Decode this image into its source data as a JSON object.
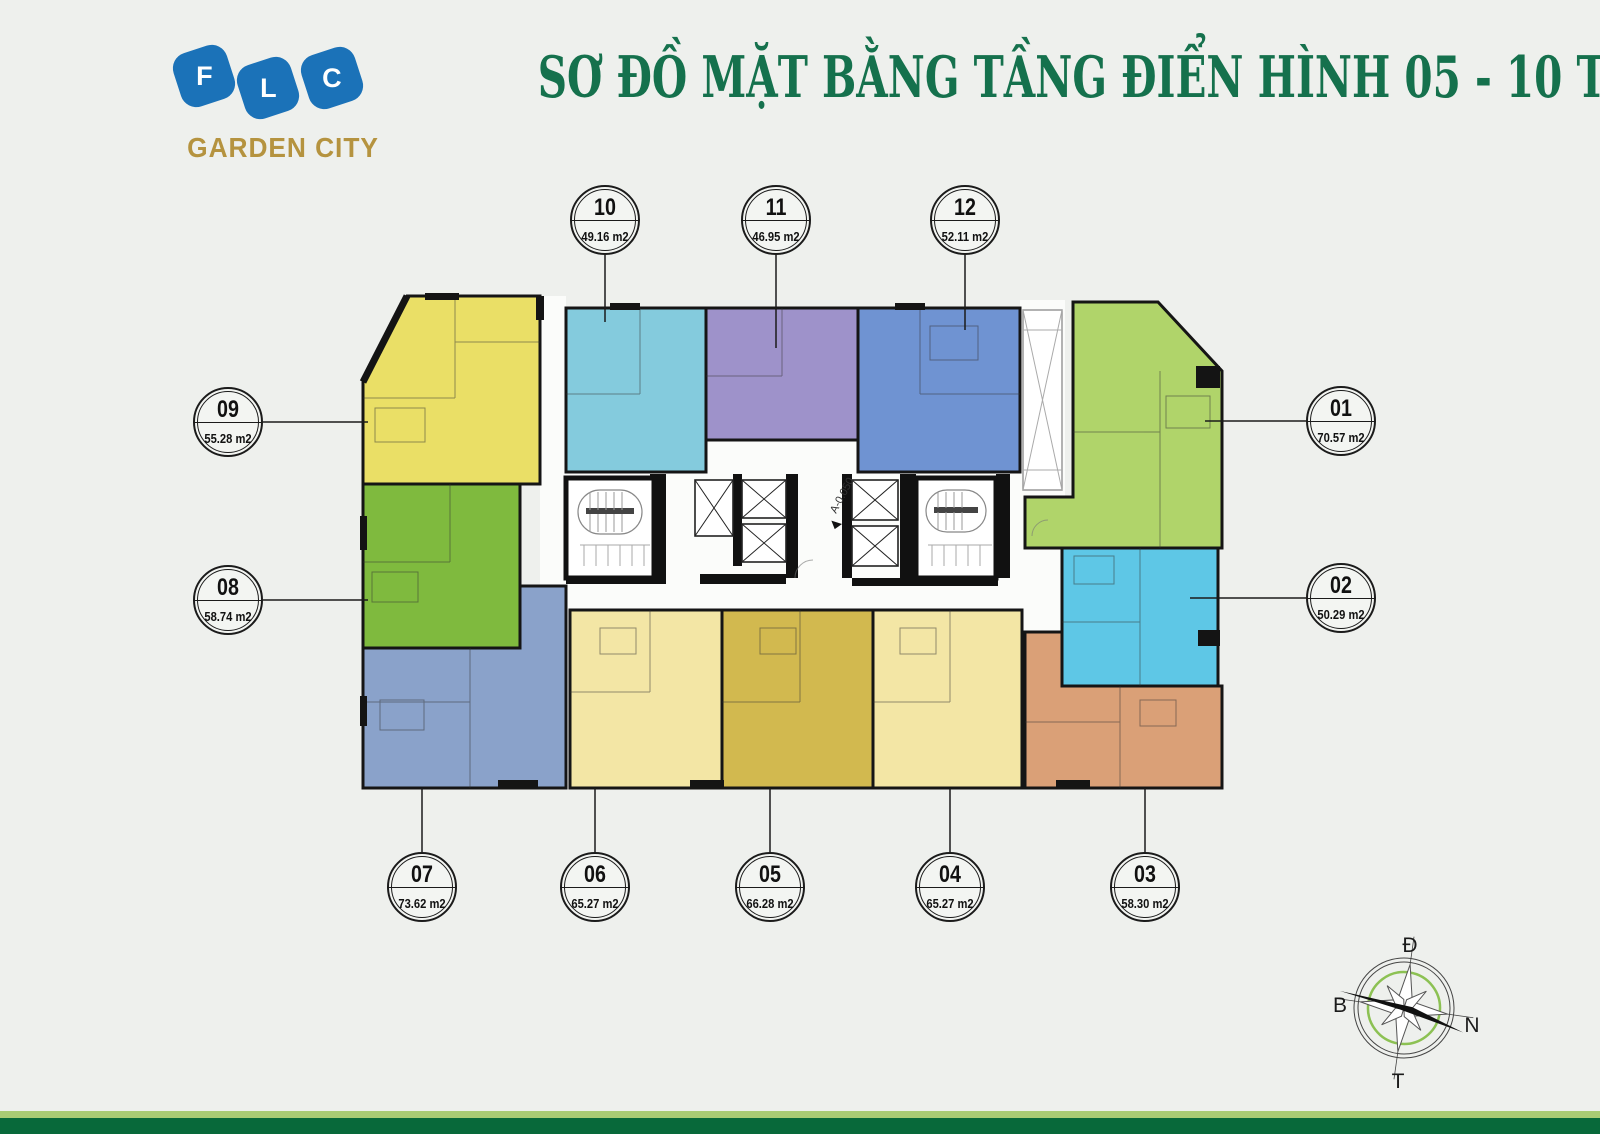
{
  "header": {
    "title": "SƠ ĐỒ MẶT BẰNG TẦNG ĐIỂN HÌNH 05 - 10 TÒA HH4",
    "title_color": "#15714d"
  },
  "logo": {
    "letters": [
      "F",
      "L",
      "C"
    ],
    "subtitle": "GARDEN CITY",
    "brand_blue": "#1b72b8",
    "brand_gold": "#b5933f"
  },
  "callouts": {
    "u01": {
      "number": "01",
      "area": "70.57 m2",
      "color": "#b0d46a"
    },
    "u02": {
      "number": "02",
      "area": "50.29 m2",
      "color": "#5ec7e6"
    },
    "u03": {
      "number": "03",
      "area": "58.30 m2",
      "color": "#daa077"
    },
    "u04": {
      "number": "04",
      "area": "65.27 m2",
      "color": "#f3e6a5"
    },
    "u05": {
      "number": "05",
      "area": "66.28 m2",
      "color": "#d2b94f"
    },
    "u06": {
      "number": "06",
      "area": "65.27 m2",
      "color": "#f3e6a5"
    },
    "u07": {
      "number": "07",
      "area": "73.62 m2",
      "color": "#8aa2ca"
    },
    "u08": {
      "number": "08",
      "area": "58.74 m2",
      "color": "#7fba3e"
    },
    "u09": {
      "number": "09",
      "area": "55.28 m2",
      "color": "#eadf66"
    },
    "u10": {
      "number": "10",
      "area": "49.16 m2",
      "color": "#84cbdd"
    },
    "u11": {
      "number": "11",
      "area": "46.95 m2",
      "color": "#9e92ca"
    },
    "u12": {
      "number": "12",
      "area": "52.11 m2",
      "color": "#6f93d2"
    }
  },
  "plan": {
    "core_label": "A-0.050"
  },
  "compass": {
    "top": "Đ",
    "left": "B",
    "right": "N",
    "bottom": "T"
  },
  "footer": {
    "stripe_light": "#a9cb74",
    "stripe_dark": "#08693a"
  },
  "background": "#eef0ed"
}
